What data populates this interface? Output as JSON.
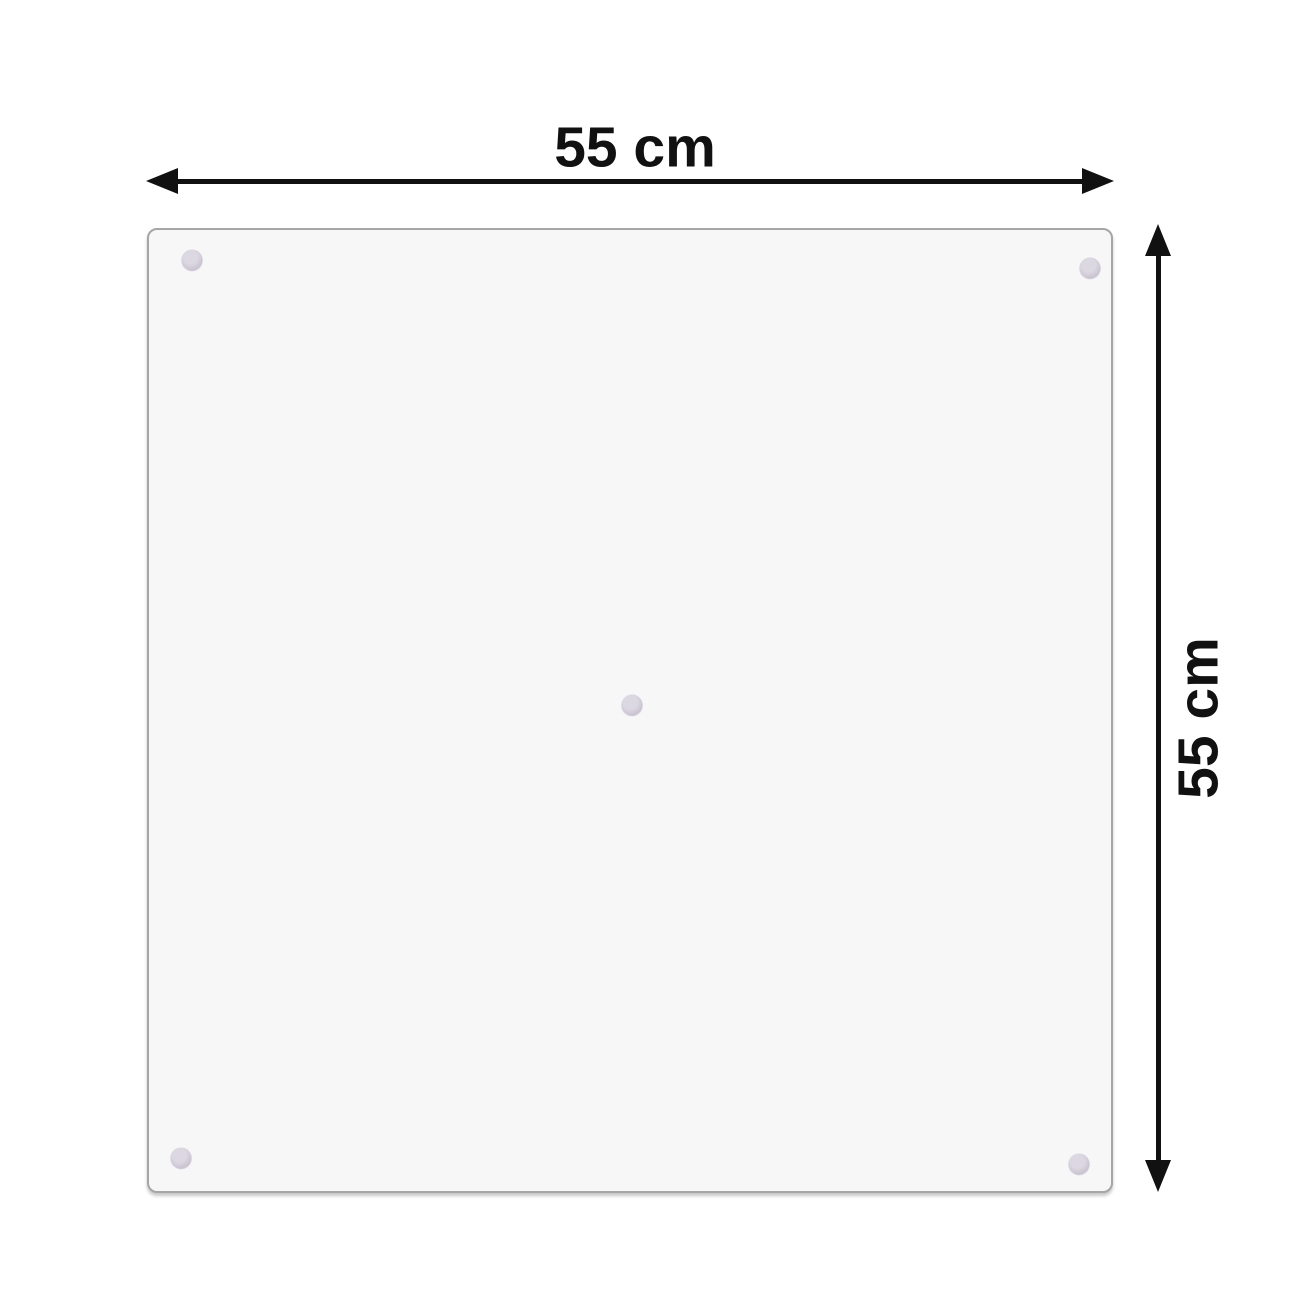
{
  "diagram": {
    "type": "product-dimension-diagram",
    "product": "square glass panel with suction cup mounts",
    "width_label": "55 cm",
    "height_label": "55 cm",
    "suction_cup_count": 5
  },
  "colors": {
    "arrow_color": "#111111",
    "label_color": "#111111",
    "panel_fill": "#f7f7f7",
    "panel_border": "#a6a6a6",
    "cup_outer": "#b9b2c1",
    "cup_inner": "#dcd8e2"
  }
}
